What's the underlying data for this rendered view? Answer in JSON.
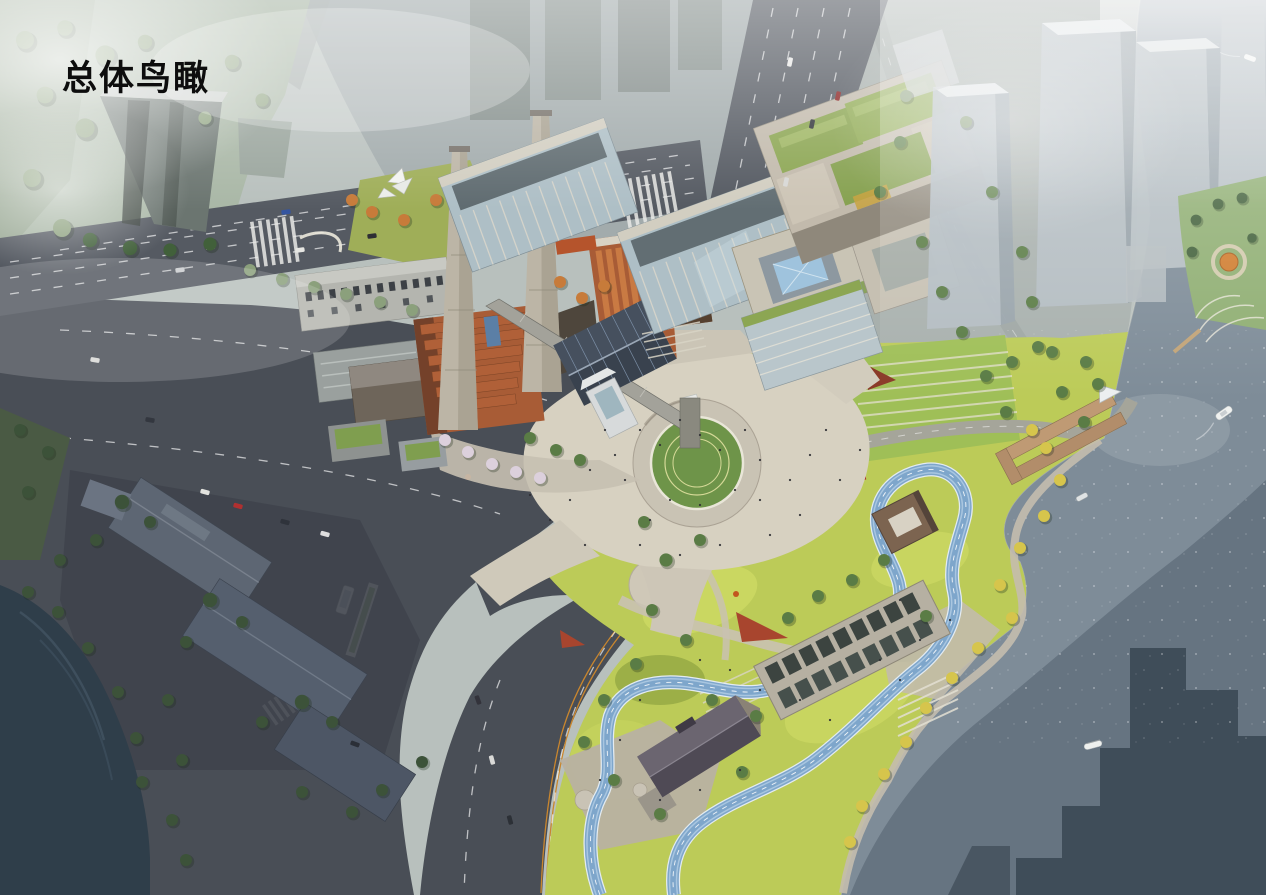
{
  "title": {
    "text": "总体鸟瞰"
  },
  "palette": {
    "haze_base": "#b8c0bd",
    "water": "#7e8c98",
    "water_shadow": "#36434f",
    "river": "#2f3e4a",
    "asphalt": "#494e56",
    "avenue": "#555a62",
    "plaza": "#d7d1c1",
    "lawn": "#6e9449",
    "park": "#bccb58",
    "track": "#7ea6cb",
    "brick": "#a85c36",
    "chimney": "#bcb5a6",
    "glass": "#aebfc6",
    "green_roof": "#8ca653",
    "tower_haze": "#b4bdc3",
    "pier": "#bf9a74",
    "corten": "#a8452e",
    "pool": "#9fc3dd",
    "mist_park": "#a9b7a6",
    "center_line": "#c9862e"
  },
  "scene": {
    "type": "aerial-masterplan-rendering",
    "landmarks": [
      "misty-parkland",
      "office-tower",
      "multi-lane-avenue",
      "corner-sculpture-plaza",
      "glass-office-blocks",
      "rooftop-pool-building",
      "convention-center-green-roofs",
      "residential-towers",
      "heritage-power-plant",
      "twin-chimneys",
      "conveyor-gallery",
      "solar-roof-shed",
      "central-circular-lawn",
      "riverside-park",
      "running-track-loop",
      "sunken-skylight-gallery",
      "park-pavilion",
      "gabled-heritage-house",
      "waterfront-piers",
      "river",
      "boats",
      "city-intersection",
      "bus-stop"
    ]
  }
}
